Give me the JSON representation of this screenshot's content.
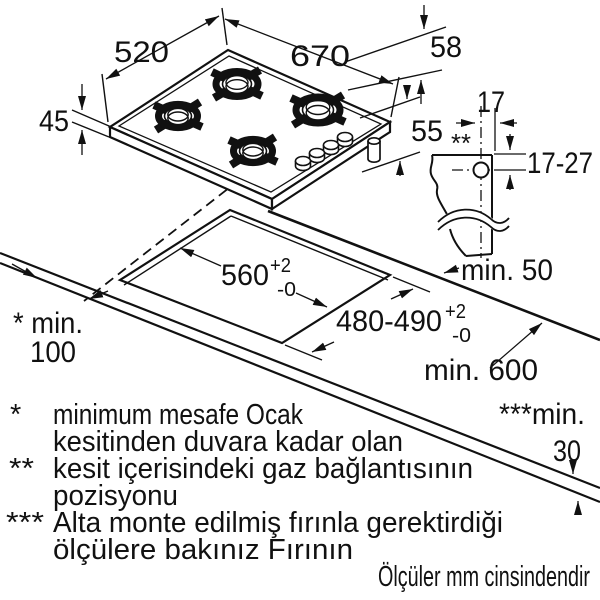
{
  "title": "hob-installation-diagram",
  "units_note": "Ölçüler mm cinsindendir",
  "colors": {
    "ink": "#111111",
    "burner_cap": "#c6c6c6"
  },
  "hob_view": {
    "width_total": "670",
    "depth_total": "520",
    "height_with_supports": "58",
    "height_left": "45",
    "height_below": "55"
  },
  "section_view": {
    "gas_offset_side": "17",
    "gas_marker": "**",
    "gas_offset_depth": "17-27"
  },
  "worktop_view": {
    "cutout_width": "560",
    "cutout_width_sup": "+2",
    "cutout_width_sub": "-0",
    "cutout_depth": "480-490",
    "cutout_depth_sup": "+2",
    "cutout_depth_sub": "-0",
    "rear_clearance": "min. 50",
    "worktop_depth": "min. 600",
    "side_clearance_marker": "* min.",
    "side_clearance_value": "100",
    "under_clearance_marker": "***min.",
    "under_clearance_value": "30"
  },
  "footnotes": [
    {
      "marker": "*",
      "line1": "minimum mesafe Ocak",
      "line2": "kesitinden duvara kadar olan"
    },
    {
      "marker": "**",
      "line1": "kesit içerisindeki gaz bağlantısının",
      "line2": "pozisyonu"
    },
    {
      "marker": "***",
      "line1": "Alta monte edilmiş fırınla gerektirdiği",
      "line2": "ölçülere bakınız Fırının"
    }
  ]
}
